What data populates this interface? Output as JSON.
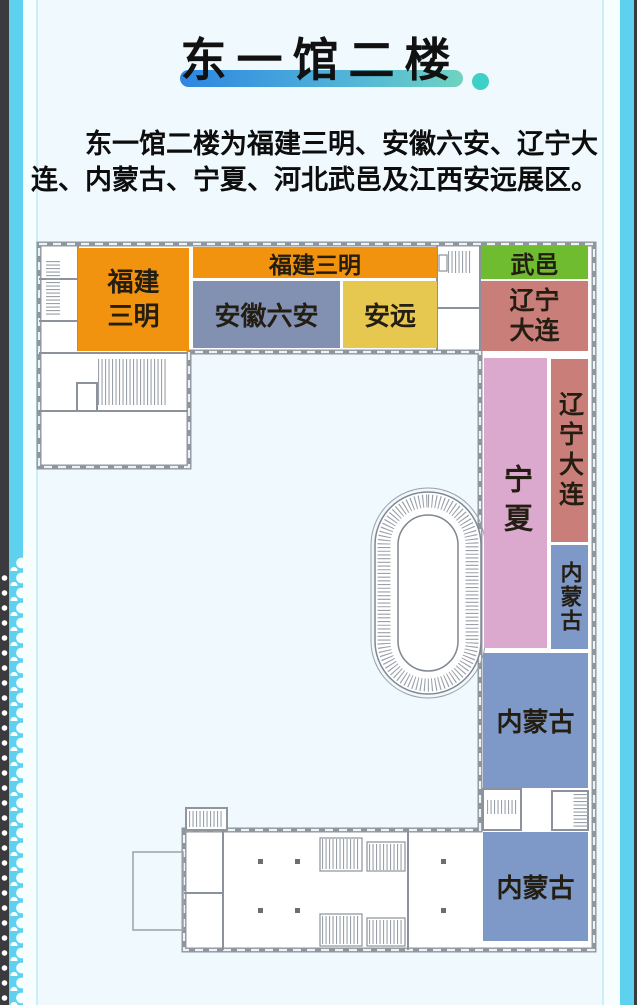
{
  "page": {
    "background": "#f0f9fd",
    "edge_dark_color": "#3b3a3e",
    "edge_cyan_color": "#5ed1ef",
    "edge_white_color": "#f6feff"
  },
  "header": {
    "title": "东一馆二楼",
    "underline_gradient_from": "#2e86e2",
    "underline_gradient_to": "#6ed3c0",
    "dot_color": "#3ecfc6"
  },
  "intro": {
    "text": "东一馆二楼为福建三明、安徽六安、辽宁大连、内蒙古、宁夏、河北武邑及江西安远展区。"
  },
  "floorplan": {
    "wall_color": "#8f969e",
    "regions": [
      {
        "id": "fujian-sanming-hall",
        "label": "福建三明",
        "lines": [
          "福建",
          "三明"
        ],
        "color": "#f2930f"
      },
      {
        "id": "fujian-sanming-strip",
        "label": "福建三明",
        "color": "#f2930f"
      },
      {
        "id": "anhui-luan",
        "label": "安徽六安",
        "color": "#8290b2"
      },
      {
        "id": "anyuan",
        "label": "安远",
        "color": "#e6c850"
      },
      {
        "id": "wuyi",
        "label": "武邑",
        "color": "#6fbc30"
      },
      {
        "id": "liaoning-dalian-north",
        "label": "辽宁大连",
        "lines": [
          "辽宁",
          "大连"
        ],
        "color": "#ca7e79"
      },
      {
        "id": "ningxia",
        "label": "宁夏",
        "color": "#dba8ce"
      },
      {
        "id": "liaoning-dalian-east",
        "label": "辽宁大连",
        "color": "#ca7e79"
      },
      {
        "id": "neimenggu-east",
        "label": "内蒙古",
        "color": "#7e99c8"
      },
      {
        "id": "neimenggu-mid",
        "label": "内蒙古",
        "color": "#7e99c8"
      },
      {
        "id": "neimenggu-south",
        "label": "内蒙古",
        "color": "#7e99c8"
      }
    ]
  }
}
